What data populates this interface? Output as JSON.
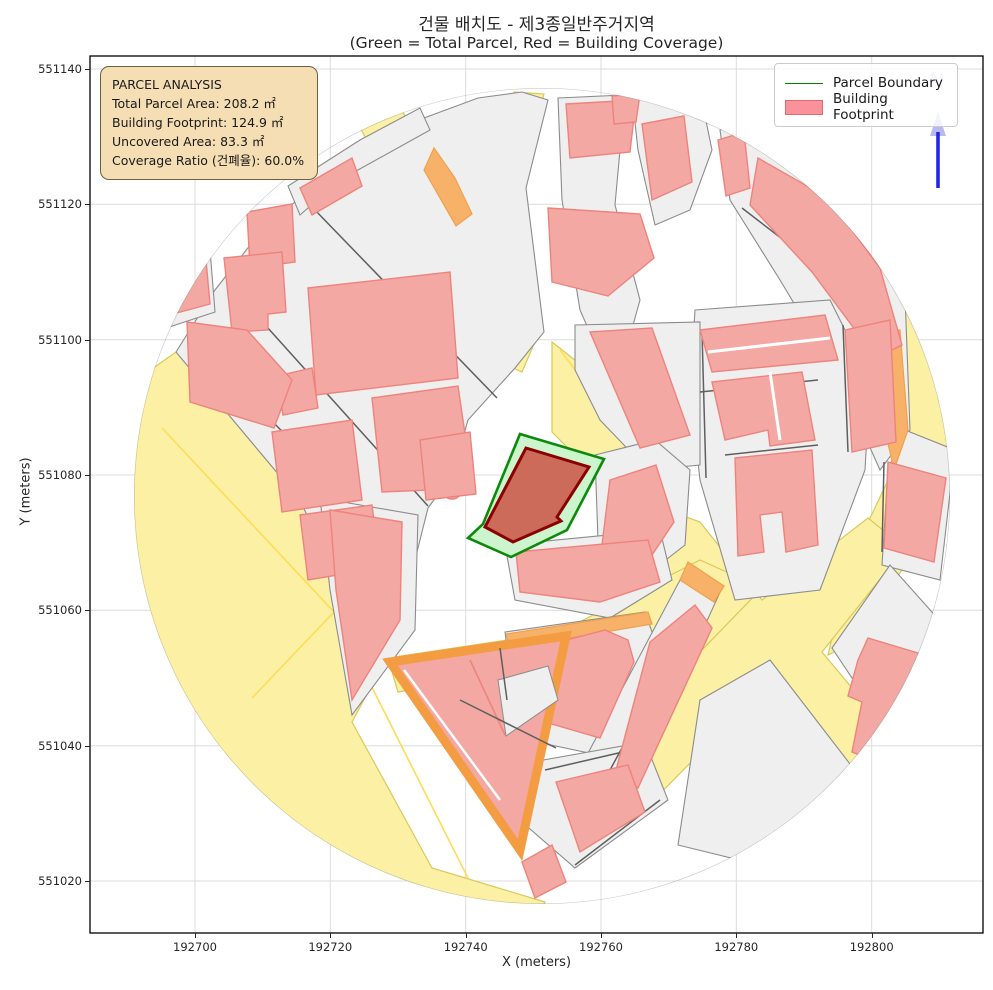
{
  "title": {
    "line1": "건물 배치도 - 제3종일반주거지역",
    "line2": "(Green = Total Parcel, Red = Building Coverage)"
  },
  "info_box": {
    "heading": "PARCEL ANALYSIS",
    "lines": [
      "Total Parcel Area: 208.2 ㎡",
      "Building Footprint: 124.9 ㎡",
      "Uncovered Area: 83.3 ㎡",
      "Coverage Ratio (건폐율): 60.0%"
    ]
  },
  "legend": {
    "items": [
      {
        "label": "Parcel Boundary",
        "type": "line",
        "color": "#008000"
      },
      {
        "label": "Building Footprint",
        "type": "patch",
        "color": "#f8808a"
      }
    ]
  },
  "axes": {
    "x_label": "X (meters)",
    "y_label": "Y (meters)",
    "x_ticks": [
      {
        "label": "192700",
        "px": 195.0
      },
      {
        "label": "192720",
        "px": 330.3
      },
      {
        "label": "192740",
        "px": 465.7
      },
      {
        "label": "192760",
        "px": 601.0
      },
      {
        "label": "192780",
        "px": 736.3
      },
      {
        "label": "192800",
        "px": 871.7
      }
    ],
    "y_ticks": [
      {
        "label": "551140",
        "py": 69.0
      },
      {
        "label": "551120",
        "py": 204.3
      },
      {
        "label": "551100",
        "py": 339.7
      },
      {
        "label": "551080",
        "py": 475.0
      },
      {
        "label": "551060",
        "py": 610.3
      },
      {
        "label": "551040",
        "py": 745.7
      },
      {
        "label": "551020",
        "py": 881.0
      }
    ]
  },
  "north_indicator": {
    "label": "N"
  },
  "map_data": {
    "type": "cadastral-parcel-map",
    "zoning_district": "제3종일반주거지역",
    "total_parcel_area_m2": 208.2,
    "building_footprint_m2": 124.9,
    "uncovered_area_m2": 83.3,
    "coverage_ratio_percent": 60.0,
    "x_range_m": [
      192684,
      192817
    ],
    "y_range_m": [
      551011,
      551142
    ],
    "palette": {
      "road_parcel_yellow": "#fbf0a3",
      "generic_parcel_gray": "#efefef",
      "building_pink": "#f3a8a3",
      "road_strip_orange": "#f8b168",
      "target_parcel_green": "#cdf5cd",
      "parcel_boundary_green": "#008000",
      "target_building_fill": "#cd6b5a",
      "target_building_edge": "#8b0000",
      "north_arrow_blue": "#2525e8",
      "info_box_wheat": "#f5deb3"
    }
  }
}
